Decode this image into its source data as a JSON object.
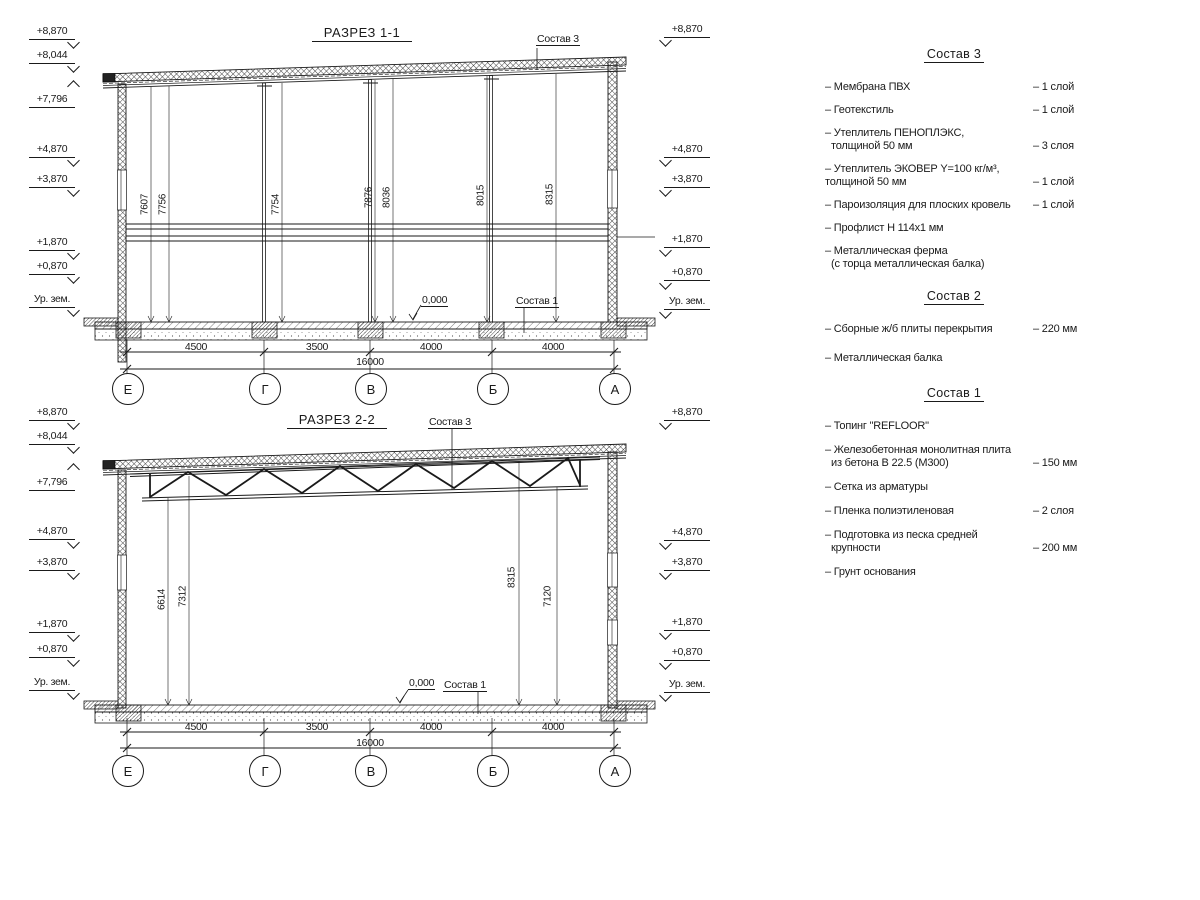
{
  "drawing": {
    "sections": [
      {
        "title": "РАЗРЕЗ 1-1",
        "roof_label": "Состав 3",
        "floor_label": "Состав 1",
        "zero_mark": "0,000",
        "left_marks": [
          "+8,870",
          "+8,044",
          "+7,796",
          "+4,870",
          "+3,870",
          "+1,870",
          "+0,870",
          "Ур. зем."
        ],
        "right_marks": [
          "+8,870",
          "+4,870",
          "+3,870",
          "+1,870",
          "+0,870",
          "Ур. зем."
        ],
        "vertical_dims": [
          "7607",
          "7756",
          "7754",
          "7876",
          "8036",
          "8015",
          "8315"
        ],
        "span_dims": [
          "4500",
          "3500",
          "4000",
          "4000"
        ],
        "total_dim": "16000",
        "axes": [
          "Е",
          "Г",
          "В",
          "Б",
          "А"
        ]
      },
      {
        "title": "РАЗРЕЗ 2-2",
        "roof_label": "Состав 3",
        "floor_label": "Состав 1",
        "zero_mark": "0,000",
        "left_marks": [
          "+8,870",
          "+8,044",
          "+7,796",
          "+4,870",
          "+3,870",
          "+1,870",
          "+0,870",
          "Ур. зем."
        ],
        "right_marks": [
          "+8,870",
          "+4,870",
          "+3,870",
          "+1,870",
          "+0,870",
          "Ур. зем."
        ],
        "vertical_dims": [
          "6614",
          "7312",
          "8315",
          "7120"
        ],
        "span_dims": [
          "4500",
          "3500",
          "4000",
          "4000"
        ],
        "total_dim": "16000",
        "axes": [
          "Е",
          "Г",
          "В",
          "Б",
          "А"
        ]
      }
    ],
    "compositions": [
      {
        "title": "Состав 3",
        "items": [
          {
            "lines": [
              "– Мембрана ПВХ"
            ],
            "qty": "– 1 слой"
          },
          {
            "lines": [
              "– Геотекстиль"
            ],
            "qty": "– 1 слой"
          },
          {
            "lines": [
              "– Утеплитель ПЕНОПЛЭКС,",
              "толщиной 50 мм"
            ],
            "qty": "– 3 слоя"
          },
          {
            "lines": [
              "– Утеплитель ЭКОВЕР Y=100 кг/м³,",
              "толщиной 50 мм"
            ],
            "qty": "– 1 слой"
          },
          {
            "lines": [
              "– Пароизоляция для плоских кровель"
            ],
            "qty": "– 1 слой"
          },
          {
            "lines": [
              "– Профлист Н 114х1 мм"
            ],
            "qty": ""
          },
          {
            "lines": [
              "– Металлическая ферма",
              "(с торца металлическая балка)"
            ],
            "qty": ""
          }
        ]
      },
      {
        "title": "Состав 2",
        "items": [
          {
            "lines": [
              "– Сборные ж/б плиты перекрытия"
            ],
            "qty": "– 220 мм"
          },
          {
            "lines": [
              "– Металлическая балка"
            ],
            "qty": ""
          }
        ]
      },
      {
        "title": "Состав 1",
        "items": [
          {
            "lines": [
              "– Топинг \"REFLOOR\""
            ],
            "qty": ""
          },
          {
            "lines": [
              "– Железобетонная  монолитная плита",
              "из бетона В 22.5 (М300)"
            ],
            "qty": "– 150 мм"
          },
          {
            "lines": [
              "– Сетка из арматуры"
            ],
            "qty": ""
          },
          {
            "lines": [
              "– Пленка полиэтиленовая"
            ],
            "qty": "– 2 слоя"
          },
          {
            "lines": [
              "– Подготовка из песка средней",
              "крупности"
            ],
            "qty": "– 200 мм"
          },
          {
            "lines": [
              "– Грунт основания"
            ],
            "qty": ""
          }
        ]
      }
    ]
  }
}
